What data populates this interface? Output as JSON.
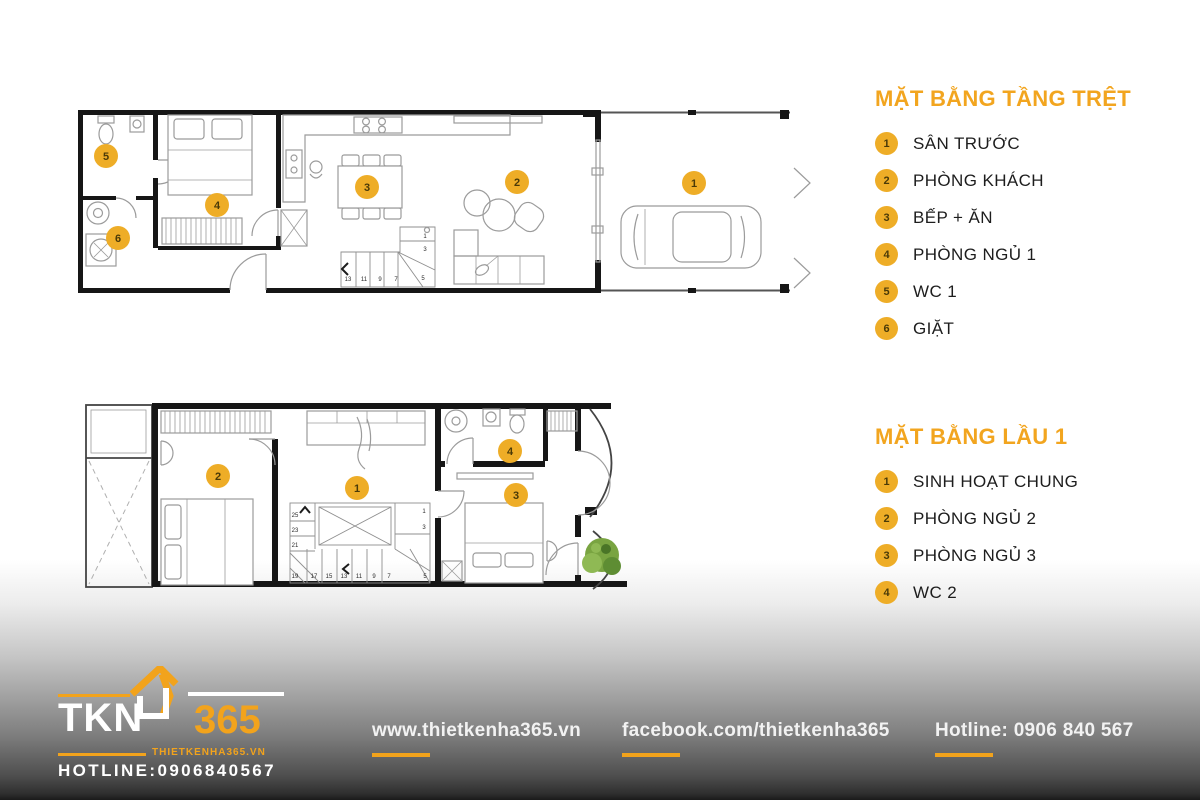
{
  "colors": {
    "accent_orange": "#F2A51F",
    "marker_orange": "#EEAD27",
    "wall_black": "#161616",
    "furniture_gray": "#9b9b9b",
    "footer_text": "#f2f2f2"
  },
  "ground_floor": {
    "title": "MẶT BẰNG TẦNG TRỆT",
    "legend": [
      {
        "num": "1",
        "label": "SÂN TRƯỚC"
      },
      {
        "num": "2",
        "label": "PHÒNG KHÁCH"
      },
      {
        "num": "3",
        "label": "BẾP + ĂN"
      },
      {
        "num": "4",
        "label": "PHÒNG NGỦ 1"
      },
      {
        "num": "5",
        "label": "WC 1"
      },
      {
        "num": "6",
        "label": "GIẶT"
      }
    ],
    "stair_bottom": [
      "13",
      "11",
      "9",
      "7",
      "5"
    ],
    "stair_right": [
      "1",
      "3"
    ]
  },
  "first_floor": {
    "title": "MẶT BẰNG LẦU 1",
    "legend": [
      {
        "num": "1",
        "label": "SINH HOẠT CHUNG"
      },
      {
        "num": "2",
        "label": "PHÒNG NGỦ 2"
      },
      {
        "num": "3",
        "label": "PHÒNG NGỦ 3"
      },
      {
        "num": "4",
        "label": "WC 2"
      }
    ],
    "stair_left": [
      "25",
      "23",
      "21"
    ],
    "stair_bottom": [
      "19",
      "17",
      "15",
      "13",
      "11",
      "9",
      "7"
    ],
    "stair_right": [
      "1",
      "3",
      "5"
    ]
  },
  "footer": {
    "logo": {
      "tkn": "TKN",
      "num365": "365",
      "site": "THIETKENHA365.VN",
      "hotline": "HOTLINE:0906840567"
    },
    "links": [
      {
        "text": "www.thietkenha365.vn"
      },
      {
        "text": "facebook.com/thietkenha365"
      },
      {
        "text": "Hotline: 0906 840 567"
      }
    ]
  }
}
